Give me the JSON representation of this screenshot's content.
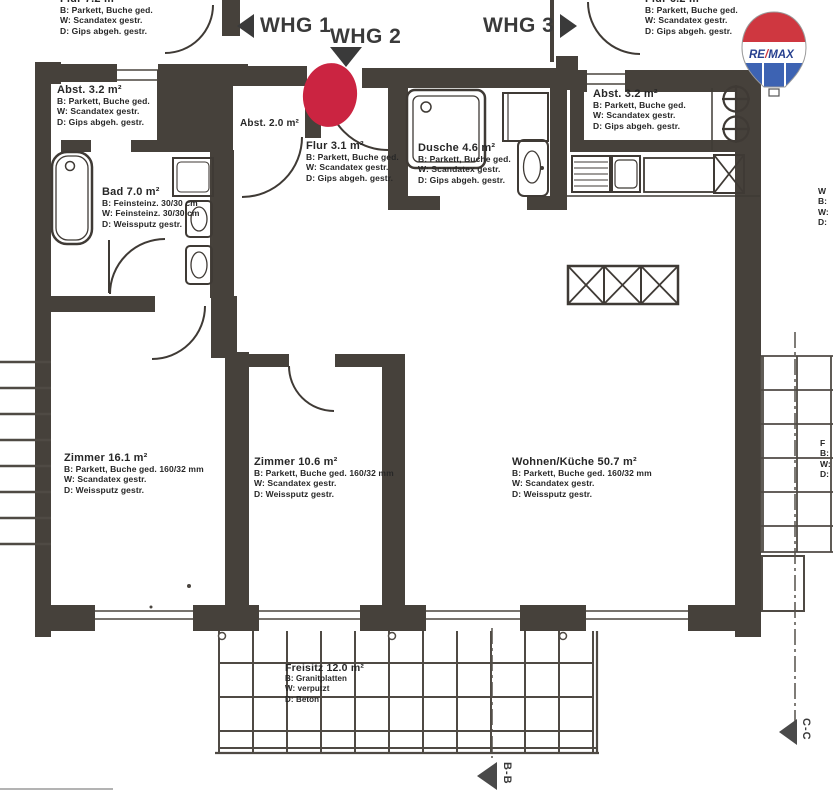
{
  "apartment_labels": [
    {
      "label": "WHG 1",
      "arrow": "left"
    },
    {
      "label": "WHG 2",
      "arrow": "down"
    },
    {
      "label": "WHG 3",
      "arrow": "right"
    }
  ],
  "rooms": [
    {
      "id": "flur-upper-left",
      "title": "Flur 7.2 m²",
      "lines": [
        "B: Parkett, Buche ged.",
        "W: Scandatex gestr.",
        "D: Gips abgeh. gestr."
      ]
    },
    {
      "id": "abstellraum-left",
      "title": "Abst. 3.2 m²",
      "lines": [
        "B: Parkett, Buche ged.",
        "W: Scandatex gestr.",
        "D: Gips abgeh. gestr."
      ]
    },
    {
      "id": "abstellraum-2",
      "title": "Abst. 2.0 m²",
      "lines": []
    },
    {
      "id": "flur",
      "title": "Flur 3.1 m²",
      "lines": [
        "B: Parkett, Buche ged.",
        "W: Scandatex gestr.",
        "D: Gips abgeh. gestr."
      ]
    },
    {
      "id": "dusche",
      "title": "Dusche 4.6 m²",
      "lines": [
        "B: Parkett, Buche ged.",
        "W: Scandatex gestr.",
        "D: Gips abgeh. gestr."
      ]
    },
    {
      "id": "bad",
      "title": "Bad 7.0 m²",
      "lines": [
        "B: Feinsteinz. 30/30 cm",
        "W: Feinsteinz. 30/30 cm",
        "D: Weissputz gestr."
      ]
    },
    {
      "id": "flur-upper-right",
      "title": "Flur 6.2 m²",
      "lines": [
        "B: Parkett, Buche ged.",
        "W: Scandatex gestr.",
        "D: Gips abgeh. gestr."
      ]
    },
    {
      "id": "abstellraum-right",
      "title": "Abst. 3.2 m²",
      "lines": [
        "B: Parkett, Buche ged.",
        "W: Scandatex gestr.",
        "D: Gips abgeh. gestr."
      ]
    },
    {
      "id": "zimmer-1",
      "title": "Zimmer 16.1 m²",
      "lines": [
        "B: Parkett, Buche ged. 160/32 mm",
        "W: Scandatex gestr.",
        "D: Weissputz gestr."
      ]
    },
    {
      "id": "zimmer-2",
      "title": "Zimmer 10.6 m²",
      "lines": [
        "B: Parkett, Buche ged. 160/32 mm",
        "W: Scandatex gestr.",
        "D: Weissputz gestr."
      ]
    },
    {
      "id": "wohnen-kueche",
      "title": "Wohnen/Küche 50.7 m²",
      "lines": [
        "B: Parkett, Buche ged. 160/32 mm",
        "W: Scandatex gestr.",
        "D: Weissputz gestr."
      ]
    },
    {
      "id": "freisitz",
      "title": "Freisitz 12.0 m²",
      "lines": [
        "B: Granitplatten",
        "W: verputzt",
        "D: Beton"
      ]
    }
  ],
  "section_markers": [
    {
      "label": "B-B"
    },
    {
      "label": "C-C"
    }
  ],
  "edge_labels": [
    {
      "lines": [
        "W",
        "B:",
        "W:",
        "D:"
      ]
    },
    {
      "lines": [
        "F",
        "B:",
        "W:",
        "D:"
      ]
    }
  ],
  "logo": {
    "re": "RE",
    "slash": "/",
    "max": "MAX"
  },
  "colors": {
    "wall": "#46413b",
    "line": "#4a453f",
    "entrance_marker": "#cb2441",
    "logo_red": "#cf3740",
    "logo_blue": "#3d63b3",
    "logo_text": "#27408f"
  }
}
